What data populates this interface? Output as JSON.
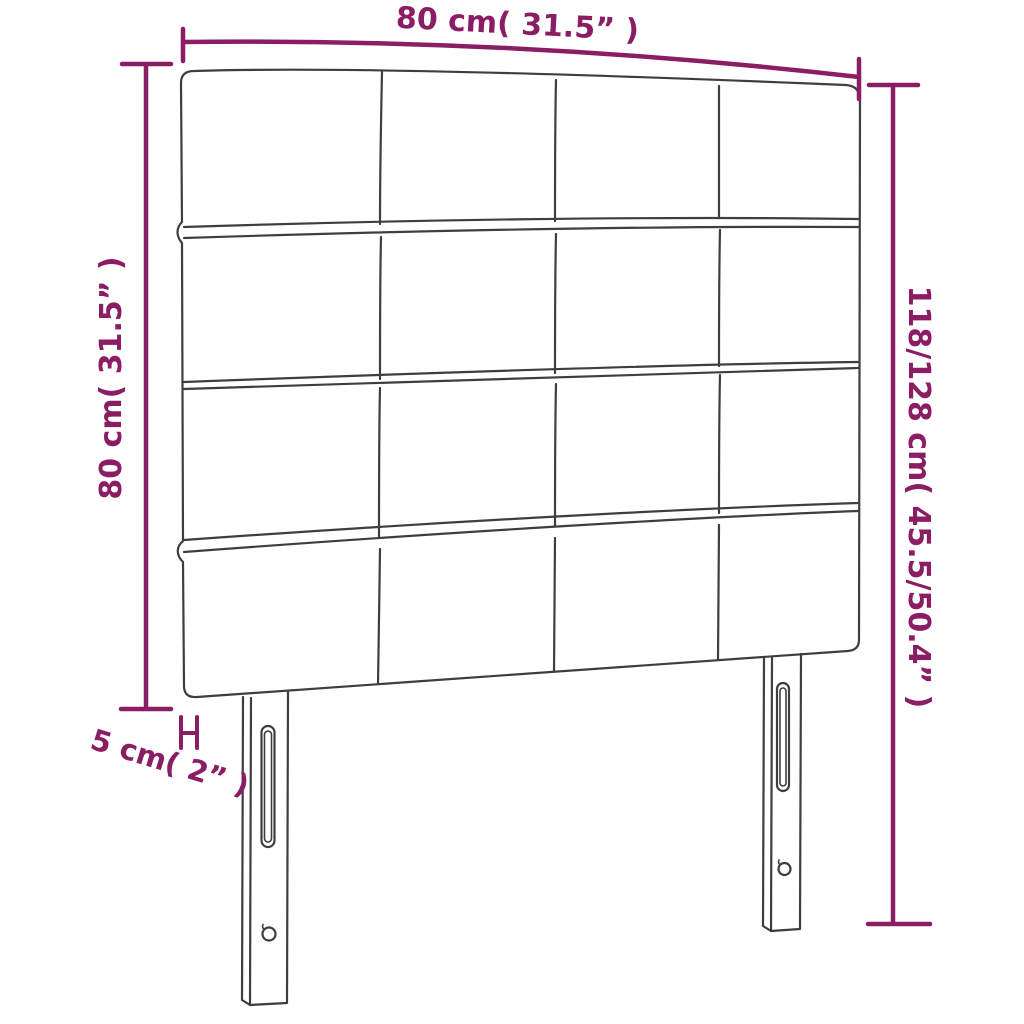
{
  "diagram": {
    "product": "headboard-dimension-diagram",
    "dimensions": {
      "width_label": "80 cm( 31.5” )",
      "height_label": "80 cm( 31.5” )",
      "total_height_label": "118/128 cm( 45.5/50.4” )",
      "leg_offset_label": "5 cm( 2” )"
    },
    "colors": {
      "dimension": "#8a1d63",
      "outline": "#3e3e3e",
      "background": "#ffffff"
    },
    "headboard": {
      "panel_rows": 4,
      "panel_columns": 4,
      "legs": 2
    }
  }
}
